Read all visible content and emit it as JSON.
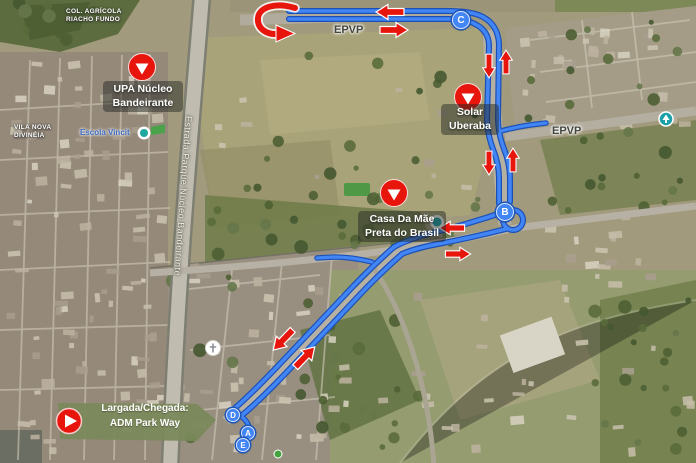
{
  "map": {
    "area_labels": {
      "col_agricola": {
        "line1": "COL. AGRÍCOLA",
        "line2": "RIACHO FUNDO"
      },
      "vila_nova": {
        "line1": "VILA NOVA",
        "line2": "DIVINÉIA"
      }
    },
    "road_labels": {
      "estrada_parque": "Estrada Parque Núcleo Bandeirante",
      "epvp_north": "EPVP",
      "epvp_east": "EPVP"
    },
    "pois": {
      "escola": {
        "label": "Escola Vincit"
      },
      "upa": {
        "line1": "UPA Núcleo",
        "line2": "Bandeirante"
      },
      "solar": {
        "line1": "Solar",
        "line2": "Uberaba"
      },
      "casa": {
        "line1": "Casa Da Mãe",
        "line2": "Preta do Brasil"
      }
    },
    "route_markers": {
      "a": "A",
      "b": "B",
      "c": "C",
      "d": "D",
      "e": "E"
    },
    "start_banner": {
      "line1": "Largada/Chegada:",
      "line2": "ADM Park Way"
    },
    "colors": {
      "route_blue": "#4285F4",
      "route_casing": "#1B4FB5",
      "arrow_red": "#E8150D",
      "banner_green": "#7A8959",
      "poi_marker_red": "#E8150D"
    }
  }
}
